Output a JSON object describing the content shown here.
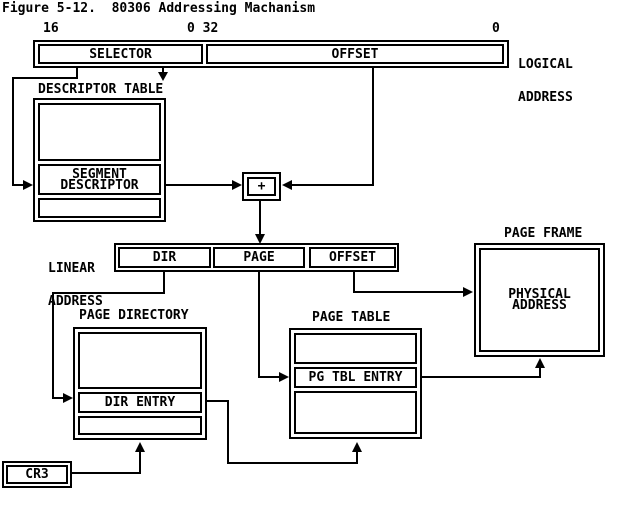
{
  "title": "Figure 5-12.  80306 Addressing Machanism",
  "colors": {
    "ink": "#000000",
    "paper": "#ffffff"
  },
  "logical_address": {
    "bit_label_left": "16",
    "bit_label_middle": "0 32",
    "bit_label_right": "0",
    "selector": "SELECTOR",
    "offset": "OFFSET",
    "caption": [
      "LOGICAL",
      "ADDRESS"
    ]
  },
  "descriptor_table": {
    "title": "DESCRIPTOR TABLE",
    "segment_descriptor": [
      "SEGMENT",
      "DESCRIPTOR"
    ]
  },
  "adder": {
    "symbol": "+"
  },
  "linear_address": {
    "caption": [
      "LINEAR",
      "ADDRESS"
    ],
    "fields": [
      "DIR",
      "PAGE",
      "OFFSET"
    ]
  },
  "page_directory": {
    "title": "PAGE DIRECTORY",
    "entry": "DIR ENTRY"
  },
  "page_table": {
    "title": "PAGE TABLE",
    "entry": "PG TBL ENTRY"
  },
  "page_frame": {
    "title": "PAGE FRAME",
    "content": [
      "PHYSICAL",
      "ADDRESS"
    ]
  },
  "cr3": {
    "label": "CR3"
  }
}
